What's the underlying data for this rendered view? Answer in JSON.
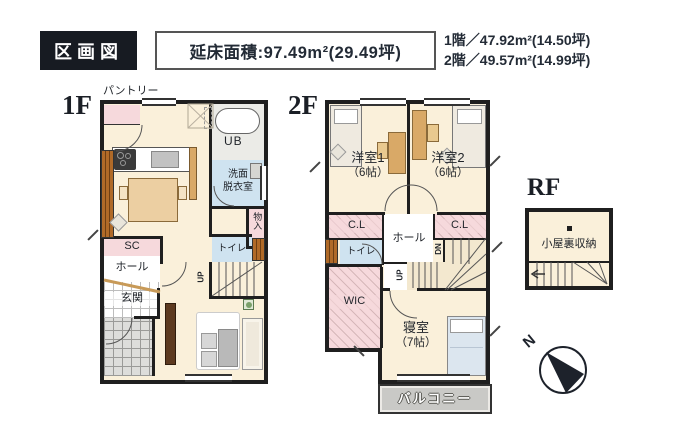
{
  "header": {
    "title": "区画図",
    "total_area": "延床面積:97.49m²(29.49坪)",
    "floor_areas": {
      "line1": "1階／47.92m²(14.50坪)",
      "line2": "2階／49.57m²(14.99坪)"
    }
  },
  "floor1": {
    "label": "1F",
    "pantry": "パントリー",
    "ldk": "ＬＤＫ",
    "ldk_size": "（19.4帖）",
    "bath": "UB",
    "washroom_line1": "洗面",
    "washroom_line2": "脱衣室",
    "storage": "物入",
    "toilet": "トイレ",
    "shoe_closet": "SC",
    "hall": "ホール",
    "entrance": "玄関",
    "stairs_up": "UP"
  },
  "floor2": {
    "label": "2F",
    "bedroom1": "洋室1",
    "bedroom1_size": "（6帖）",
    "bedroom2": "洋室2",
    "bedroom2_size": "（6帖）",
    "closet_left": "C.L",
    "closet_right": "C.L",
    "hall": "ホール",
    "toilet": "トイレ",
    "wic": "WIC",
    "master_bedroom": "寝室",
    "master_bedroom_size": "（7帖）",
    "balcony": "バルコニー",
    "stairs_down": "DN",
    "stairs_up": "UP"
  },
  "roof": {
    "label": "RF",
    "attic": "小屋裏収納"
  },
  "compass": {
    "north": "N"
  },
  "colors": {
    "wall": "#1f1f1f",
    "floor": "#faf0da",
    "wet_room": "#cfe3f0",
    "closet": "#f6d9dc",
    "balcony": "#c9c9c6",
    "ink": "#232b36",
    "wood": "#d9a967"
  }
}
